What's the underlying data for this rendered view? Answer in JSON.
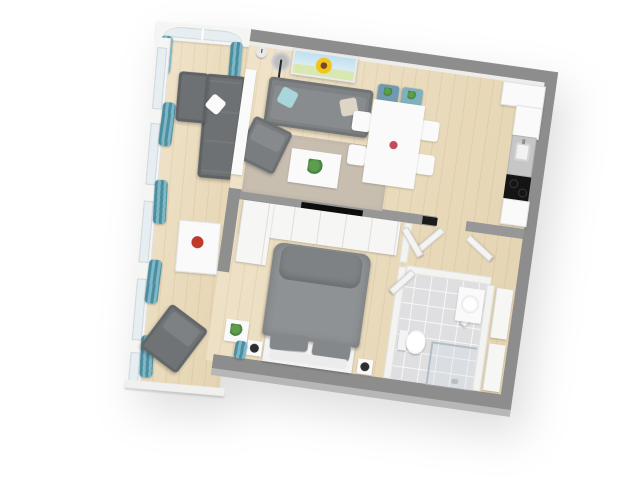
{
  "scene": {
    "description": "3D top-down rendering of a one-bedroom apartment floor plan on a white background",
    "visible_text": [],
    "rotation_deg": 8,
    "background_color": "#ffffff"
  },
  "palette": {
    "wall_top": "#8d8d8d",
    "wall_side": "#b7b7b7",
    "interior_wall": "#f3f3f2",
    "wood_floor": "#e9dabb",
    "bathroom_tile": "#dfdfe2",
    "rug": "#c8beb0",
    "sofa_gray": "#7e8284",
    "sectional_gray": "#6d7173",
    "curtain_teal": "#4c8ea1",
    "pillow_teal": "#a9d6da",
    "pillow_beige": "#ddd6c6",
    "painting_sky": "#bfe0f0",
    "sunflower_yellow": "#f2c51d",
    "dining_white": "#fbfbfb",
    "counter_gray": "#c6c6c6",
    "cooktop_black": "#141414",
    "bed_duvet": "#8e9294",
    "window_glass": "#e7eef2"
  },
  "rooms": [
    {
      "name": "living-dining-room",
      "furniture": [
        "sunflower-painting",
        "wall-clock",
        "floor-lamp",
        "sofa",
        "teal-pillow",
        "beige-pillow",
        "armchair",
        "sectional-sofa",
        "room-divider",
        "rug",
        "coffee-table",
        "coffee-table-plant",
        "dining-table",
        "dining-chairs",
        "teal-head-chairs",
        "table-flower"
      ]
    },
    {
      "name": "kitchen",
      "furniture": [
        "upper-cabinets",
        "tall-cabinet",
        "counter-with-sink",
        "cooktop",
        "base-cabinet"
      ]
    },
    {
      "name": "window-bay",
      "furniture": [
        "arch-window",
        "window-wall",
        "teal-curtains",
        "white-cabinet-with-flowers",
        "recliner-armchair"
      ]
    },
    {
      "name": "bedroom",
      "furniture": [
        "built-in-wardrobes",
        "corner-wardrobe",
        "wall-tv",
        "double-bed",
        "bed-pillows",
        "nightstands",
        "plant-table",
        "south-window-curtain"
      ]
    },
    {
      "name": "bathroom",
      "furniture": [
        "tiled-floor",
        "toilet",
        "round-sink",
        "corner-shower-glass",
        "bathroom-door"
      ]
    },
    {
      "name": "entry-hall",
      "furniture": [
        "hall-closets",
        "open-doors",
        "fuse-box"
      ]
    }
  ]
}
